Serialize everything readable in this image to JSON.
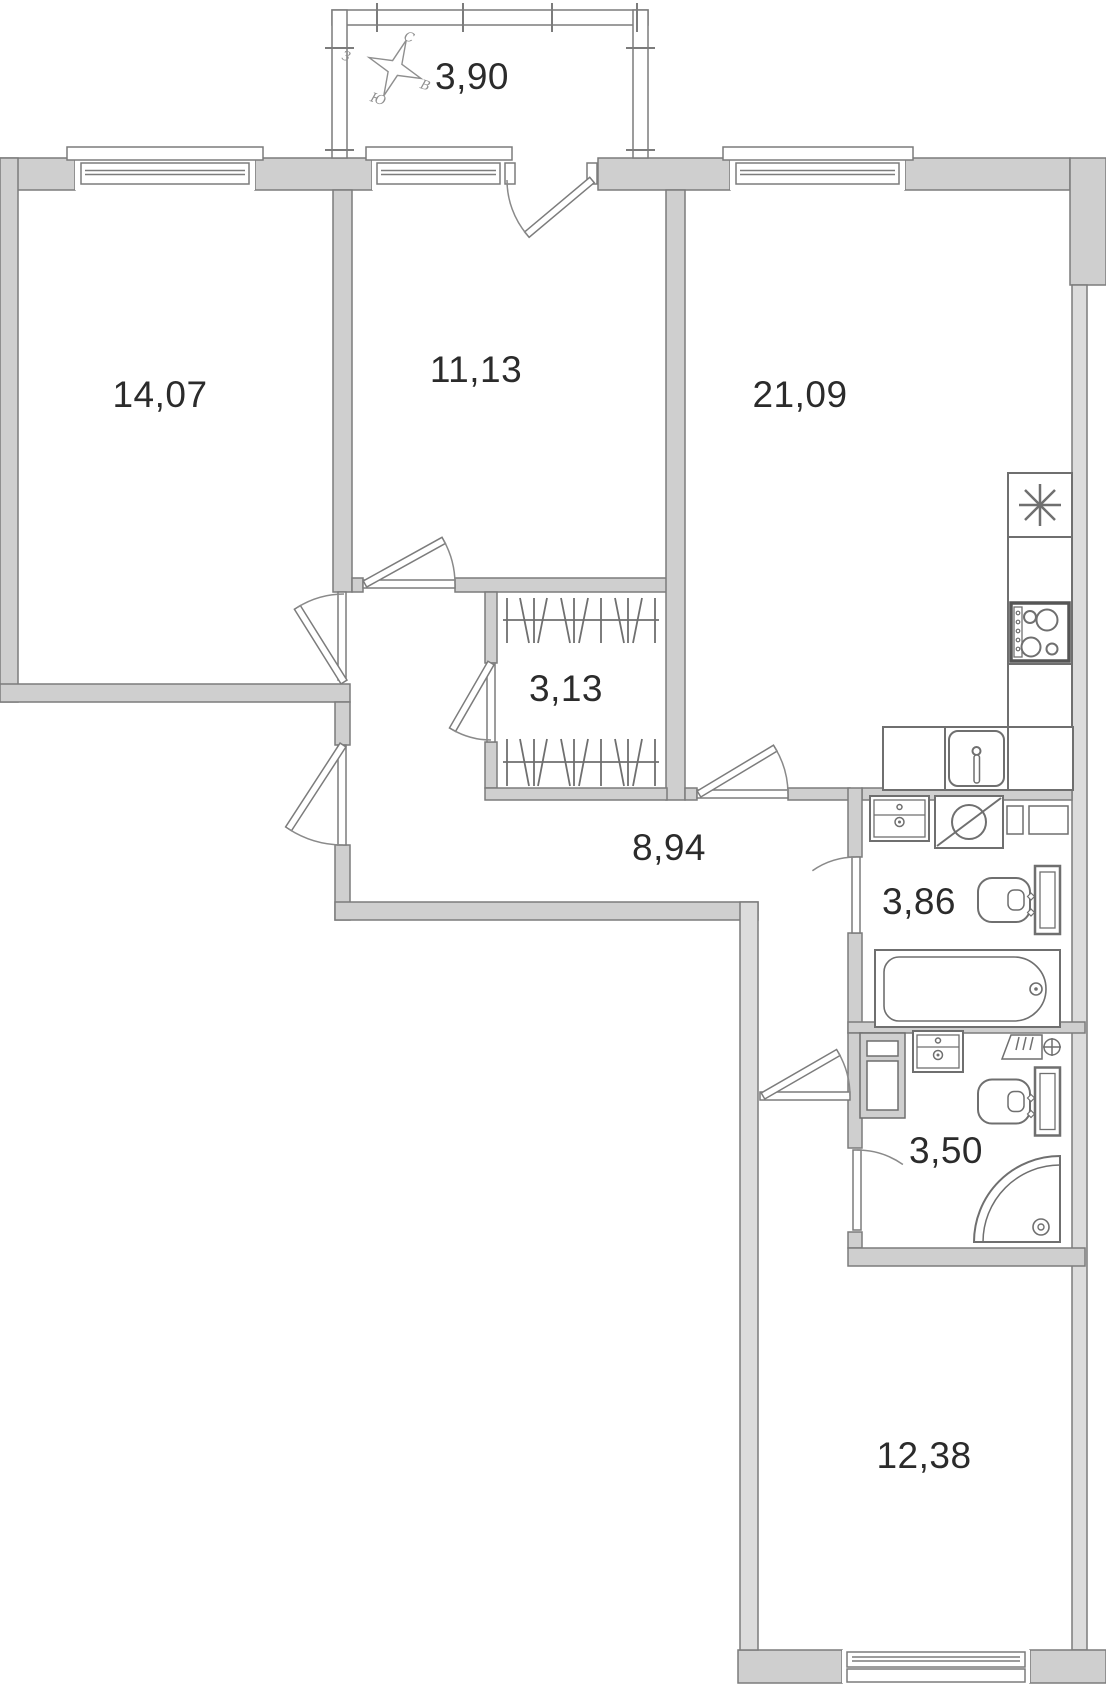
{
  "plan": {
    "type": "apartment-floor-plan",
    "compass": {
      "north": "С",
      "east": "В",
      "south": "Ю",
      "west": "З"
    },
    "rooms": [
      {
        "name": "balcony",
        "area": "3,90"
      },
      {
        "name": "bedroom-left",
        "area": "14,07"
      },
      {
        "name": "bedroom-middle",
        "area": "11,13"
      },
      {
        "name": "kitchen-living-room",
        "area": "21,09"
      },
      {
        "name": "wardrobe",
        "area": "3,13"
      },
      {
        "name": "hallway",
        "area": "8,94"
      },
      {
        "name": "bathroom",
        "area": "3,86"
      },
      {
        "name": "shower-room",
        "area": "3,50"
      },
      {
        "name": "bedroom-bottom",
        "area": "12,38"
      }
    ],
    "fixtures": [
      "compass-rose-icon",
      "fridge-icon",
      "stove-icon",
      "kitchen-sink-icon",
      "vanity-sink-icon",
      "washing-machine-icon",
      "vent-shaft-icon",
      "toilet-icon",
      "bathtub-icon",
      "cabinet-icon",
      "towel-dryer-icon",
      "shower-tray-icon",
      "wardrobe-rail-icon",
      "door-swing-icon",
      "window-icon"
    ],
    "colors": {
      "wall_fill": "#cfcfcf",
      "wall_side_fill": "#dcdcdc",
      "wall_stroke": "#7c7c7c",
      "fixture_line": "#6f6f6f",
      "text": "#2b2b2b",
      "compass_text": "#8f8f8f"
    }
  }
}
